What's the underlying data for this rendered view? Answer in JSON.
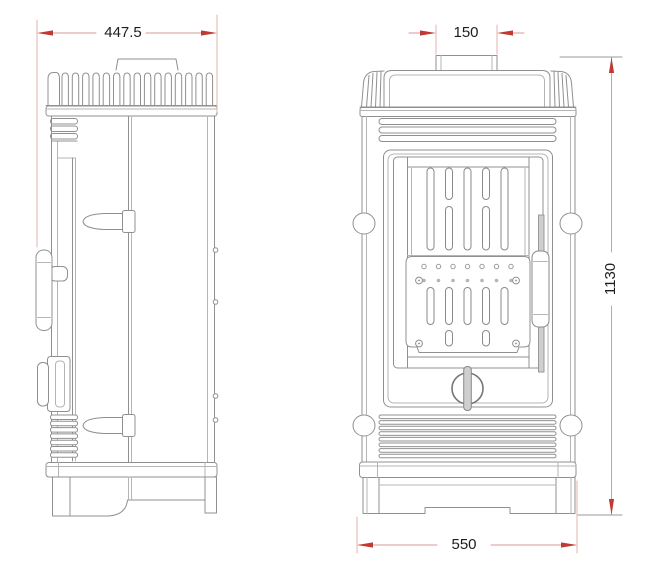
{
  "drawing": {
    "dimensions": {
      "depth": "447.5",
      "flue_width": "150",
      "height": "1130",
      "base_width": "550"
    },
    "colors": {
      "dimension_accent": "#bf3a32",
      "dimension_line": "#d89a94",
      "extension_line": "#e3b3ae",
      "line_gray": "#909090"
    }
  }
}
